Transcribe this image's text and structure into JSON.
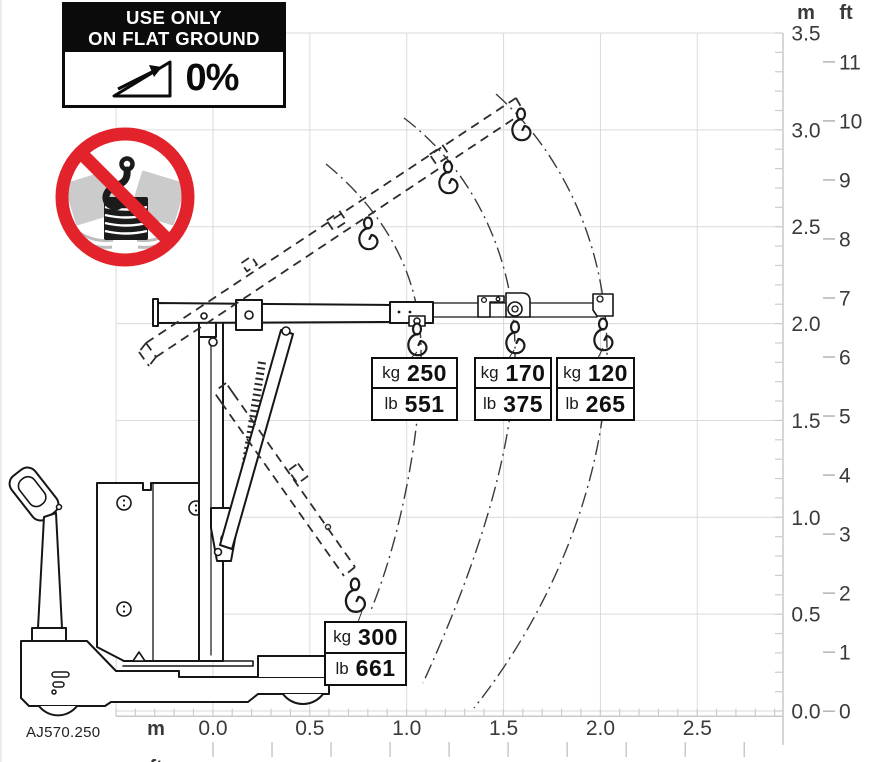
{
  "figure": {
    "code": "AJ570.250"
  },
  "warning_sign": {
    "title_line1": "USE ONLY",
    "title_line2": "ON FLAT GROUND",
    "slope_label": "0%"
  },
  "prohibition_sign": {
    "meaning": "no swinging suspended load"
  },
  "capacity_labels": [
    {
      "kg_unit": "kg",
      "kg_value": "250",
      "lb_unit": "lb",
      "lb_value": "551"
    },
    {
      "kg_unit": "kg",
      "kg_value": "170",
      "lb_unit": "lb",
      "lb_value": "375"
    },
    {
      "kg_unit": "kg",
      "kg_value": "120",
      "lb_unit": "lb",
      "lb_value": "265"
    },
    {
      "kg_unit": "kg",
      "kg_value": "300",
      "lb_unit": "lb",
      "lb_value": "661"
    }
  ],
  "axes": {
    "right_m": {
      "header": "m",
      "ticks": [
        "3.5",
        "3.0",
        "2.5",
        "2.0",
        "1.5",
        "1.0",
        "0.5",
        "0.0"
      ]
    },
    "right_ft": {
      "header": "ft",
      "ticks": [
        "11",
        "10",
        "9",
        "8",
        "7",
        "6",
        "5",
        "4",
        "3",
        "2",
        "1",
        "0"
      ]
    },
    "bottom_m": {
      "header": "m",
      "ticks": [
        "0.0",
        "0.5",
        "1.0",
        "1.5",
        "2.0",
        "2.5"
      ]
    },
    "bottom_ft": {
      "header": "ft",
      "ticks": [
        "0",
        "1",
        "2",
        "3",
        "4",
        "5",
        "6",
        "7",
        "8",
        "9"
      ]
    }
  },
  "colors": {
    "prohibition_red": "#e2232b",
    "grid": "#dadada",
    "line_art": "#161616",
    "label_text": "#3a3a3a"
  }
}
